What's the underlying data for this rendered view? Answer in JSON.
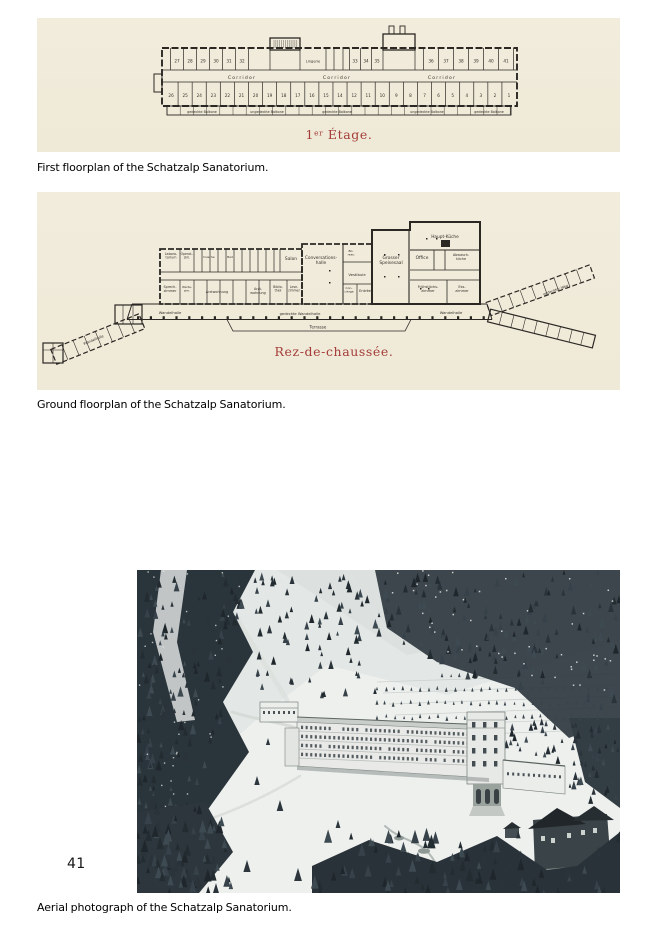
{
  "page": {
    "number": "41"
  },
  "colors": {
    "plan_paper": "#f0ead9",
    "plan_ink": "#2b2824",
    "plan_title_red": "#a43c38",
    "caption_text": "#000000"
  },
  "figures": [
    {
      "name": "first-floorplan",
      "caption": "First floorplan of the Schatzalp Sanatorium.",
      "plan": {
        "title": "1er Étage.",
        "corridors": [
          "Corridor",
          "Corridor",
          "Corridor"
        ],
        "rooms_top": [
          "27",
          "28",
          "29",
          "30",
          "31",
          "32",
          "33",
          "34",
          "35",
          "36",
          "37",
          "38",
          "39",
          "40",
          "41"
        ],
        "rooms_bottom": [
          "26",
          "25",
          "24",
          "23",
          "22",
          "21",
          "20",
          "19",
          "18",
          "17",
          "16",
          "15",
          "14",
          "12",
          "11",
          "10",
          "9",
          "8",
          "7",
          "6",
          "5",
          "4",
          "3",
          "2",
          "1"
        ],
        "linen_room": "Lingerie",
        "balconies": [
          "gedeckte Balkone",
          "ungedeckte Balkone",
          "gedeckte Balkone",
          "ungedeckte Balkone",
          "gedeckte Balkone"
        ]
      }
    },
    {
      "name": "ground-floorplan",
      "caption": "Ground floorplan of the Schatzalp Sanatorium.",
      "plan": {
        "title": "Rez-de-chaussée.",
        "rooms": [
          "Labora-\ntorium",
          "Operat.-\nzim.",
          "Dusche",
          "Bad",
          "Salon",
          "Conversations-\nhalle",
          "Bü-\nreau",
          "Vestibule",
          "Con-\ncierge",
          "Entrée",
          "Grosser\nSpeisesaal",
          "Office",
          "Haupt-Küche",
          "Abwasch-\nküche",
          "Frühstücks-\nzimmer",
          "Ess-\nzimmer",
          "Sprech-\nzimmer",
          "Warte-\nzim.",
          "Arztwohnung",
          "Arzt-\nwohnung",
          "Biblio-\nthek",
          "Lese-\nzimmer",
          "Wandelhalle",
          "gedeckte Wandelhalle",
          "Wandelhalle",
          "Terrasse",
          "Wandelhalle",
          "gedeckter Weg"
        ]
      }
    },
    {
      "name": "aerial-photo",
      "caption": "Aerial photograph of the Schatzalp Sanatorium."
    }
  ]
}
